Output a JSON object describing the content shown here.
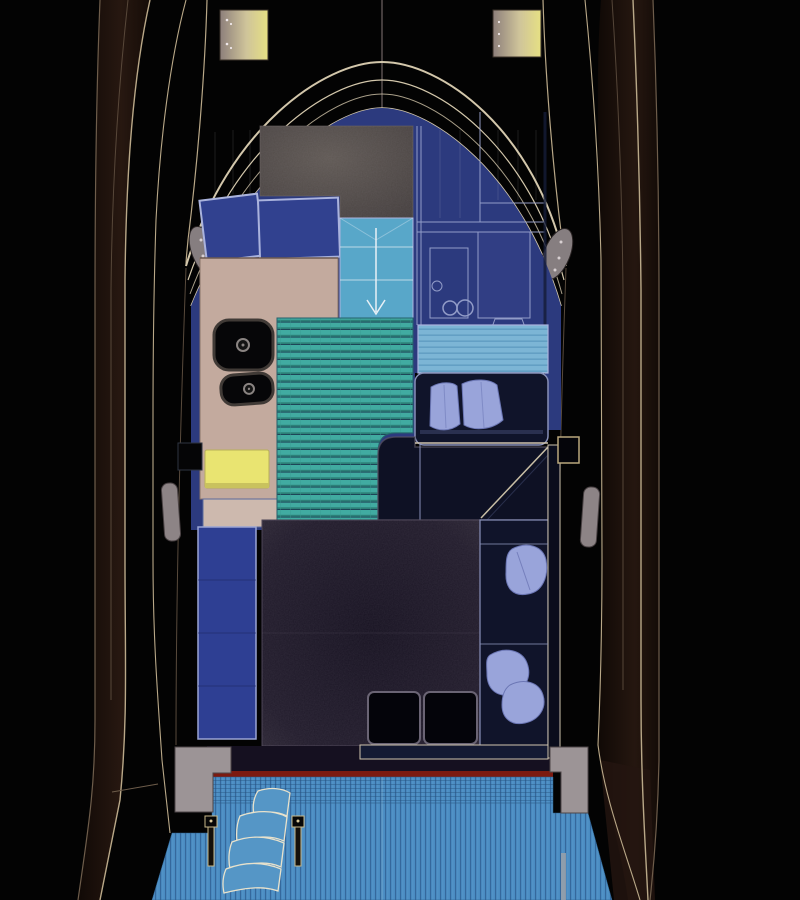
{
  "palette": {
    "background": "#030303",
    "hull_line": "#b9a888",
    "hull_line_dim": "#6e5d4b",
    "hull_shadow_dark": "#1c0f09",
    "hull_shadow_light": "#2b1a12",
    "windshield_line": "#d3c7ab",
    "cabin_blue": "#2c3a7e",
    "cushion_blue": "#31418f",
    "cushion_outline": "#aab3dd",
    "bed_gray_center": "#605954",
    "bed_gray_edge": "#453f3e",
    "console_beige": "#c3aa9e",
    "console_step_beige": "#cdb9ae",
    "locker_yellow": "#e9e471",
    "teak_teal": "#41aba1",
    "teak_teal_stripe": "#2c8078",
    "teak_teal_groove": "#16324a",
    "stairs_blue": "#58a7c9",
    "stairs_arrow": "#e8f0f6",
    "walkway_blue": "#7cb5d5",
    "walkway_stripe": "#639fc4",
    "sofa_navy": "#10142a",
    "sofa_outline": "#8890b8",
    "sofa_trim_cream": "#cfc4ae",
    "pillow_blue": "#99a4da",
    "pillow_shadow": "#6b76b4",
    "cockpit_floor_center": "#171221",
    "cockpit_floor_edge": "#2e2836",
    "cockpit_hatch_black": "#04040a",
    "bench_blue": "#2e3f93",
    "transom_red": "#7c1a10",
    "platform_blue": "#4a8cc2",
    "platform_stripe": "#35689c",
    "platform_groove": "#2d5c88",
    "step_gray": "#9c9496",
    "pad_gray": "#8d8486",
    "hatch_tan": "#8d7f7b",
    "hatch_yellow": "#e6e083",
    "post_outline": "#c9b88a",
    "fixture_black": "#060608",
    "fixture_ring": "#8a8482",
    "galley_line": "#98a2cc",
    "pillar_gray": "#867e80"
  },
  "features": {
    "foredeck_hatches": 2,
    "windshield_arch_lines": 4,
    "berth_cushions": 2,
    "companionway_treads": 3,
    "galley_sink_basins": 2,
    "console_fixtures": 2,
    "sofa_pillows": 5,
    "cockpit_floor_hatches": 2,
    "swim_platform_steps": 4,
    "stair_posts": 2,
    "transom_side_steps": 2
  }
}
